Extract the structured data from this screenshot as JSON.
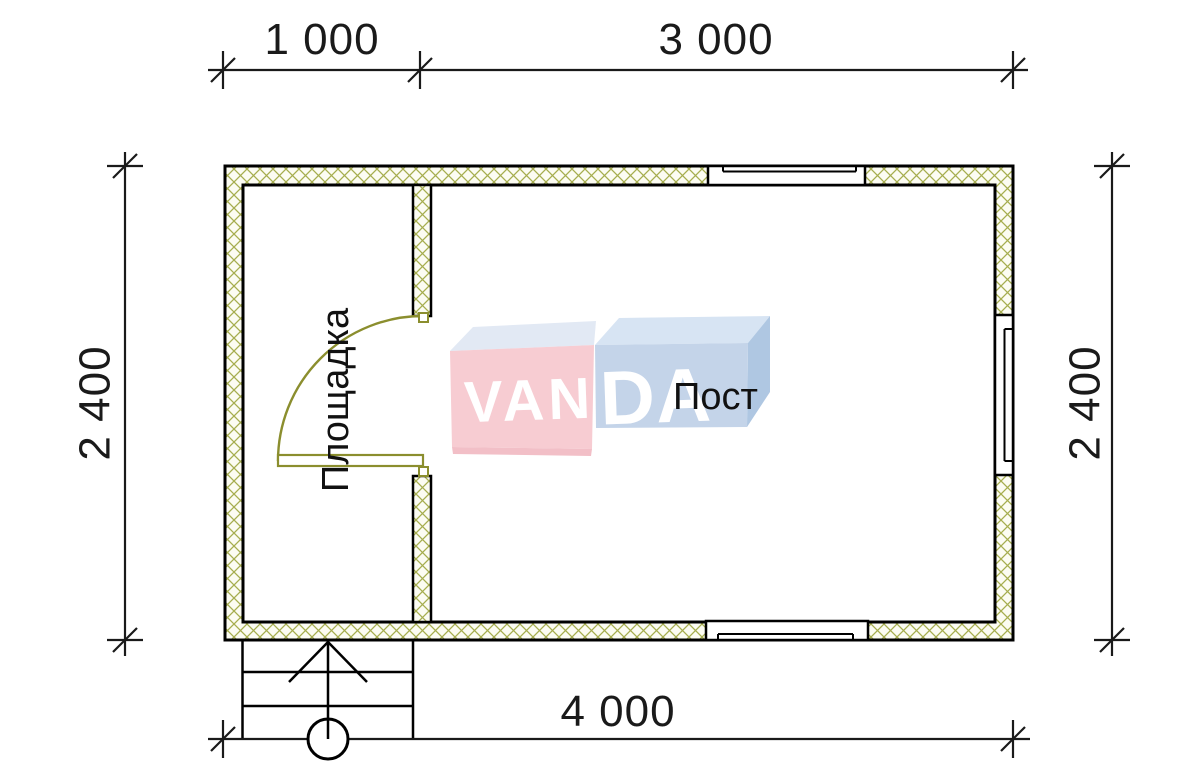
{
  "dimensions": {
    "top_segments": [
      "1 000",
      "3 000"
    ],
    "bottom_total": "4 000",
    "left_height": "2 400",
    "right_height": "2 400"
  },
  "rooms": {
    "left_room_label": "Площадка",
    "right_room_label": "Пост"
  },
  "watermark": {
    "part1": "VAN",
    "part2": "DA"
  },
  "colors": {
    "wall_hatch_line": "#a6ad4e",
    "wall_fill": "#fcfcf2",
    "door": "#8b8e2e",
    "drawing_line": "#000000",
    "watermark_pink": "#f7ccd2",
    "watermark_pink_bottom": "#f2bfc7",
    "watermark_pink_top": "#e2e9f4",
    "watermark_blue": "#c4d4e9",
    "watermark_blue_top": "#d7e4f3",
    "watermark_blue_side": "#afc7e2",
    "text": "#1a1a1a"
  }
}
